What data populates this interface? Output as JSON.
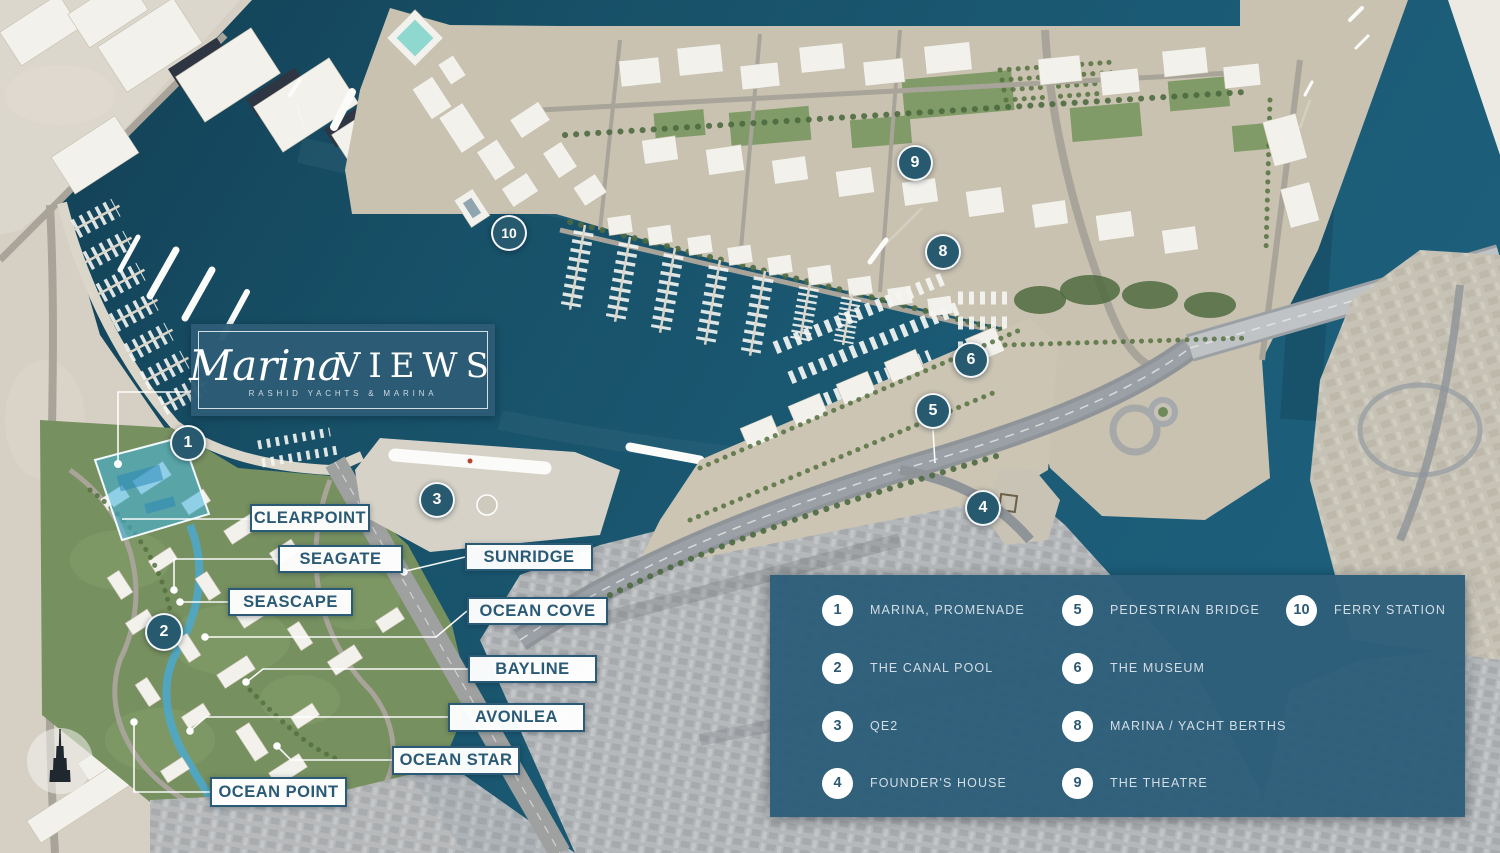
{
  "logo": {
    "script": "Marina",
    "caps": "VIEWS",
    "tagline": "RASHID YACHTS & MARINA"
  },
  "colors": {
    "accent_blue": "#2d5a73",
    "legend_panel": "#2f5f7a",
    "label_text": "#2a5a75",
    "water_deep": "#143f55",
    "water_light": "#1d5f7b",
    "site_highlight": "#3eb6e4"
  },
  "building_labels": [
    {
      "text": "CLEARPOINT"
    },
    {
      "text": "SEAGATE"
    },
    {
      "text": "SEASCAPE"
    },
    {
      "text": "SUNRIDGE"
    },
    {
      "text": "OCEAN COVE"
    },
    {
      "text": "BAYLINE"
    },
    {
      "text": "AVONLEA"
    },
    {
      "text": "OCEAN STAR"
    },
    {
      "text": "OCEAN POINT"
    }
  ],
  "markers": [
    {
      "num": "1"
    },
    {
      "num": "2"
    },
    {
      "num": "3"
    },
    {
      "num": "4"
    },
    {
      "num": "5"
    },
    {
      "num": "6"
    },
    {
      "num": "8"
    },
    {
      "num": "9"
    },
    {
      "num": "10"
    }
  ],
  "legend": {
    "columns": [
      [
        {
          "num": "1",
          "label": "MARINA, PROMENADE"
        },
        {
          "num": "2",
          "label": "THE CANAL POOL"
        },
        {
          "num": "3",
          "label": "QE2"
        },
        {
          "num": "4",
          "label": "FOUNDER'S HOUSE"
        }
      ],
      [
        {
          "num": "5",
          "label": "PEDESTRIAN BRIDGE"
        },
        {
          "num": "6",
          "label": "THE MUSEUM"
        },
        {
          "num": "8",
          "label": "MARINA / YACHT BERTHS"
        },
        {
          "num": "9",
          "label": "THE THEATRE"
        }
      ],
      [
        {
          "num": "10",
          "label": "FERRY STATION"
        }
      ]
    ]
  }
}
